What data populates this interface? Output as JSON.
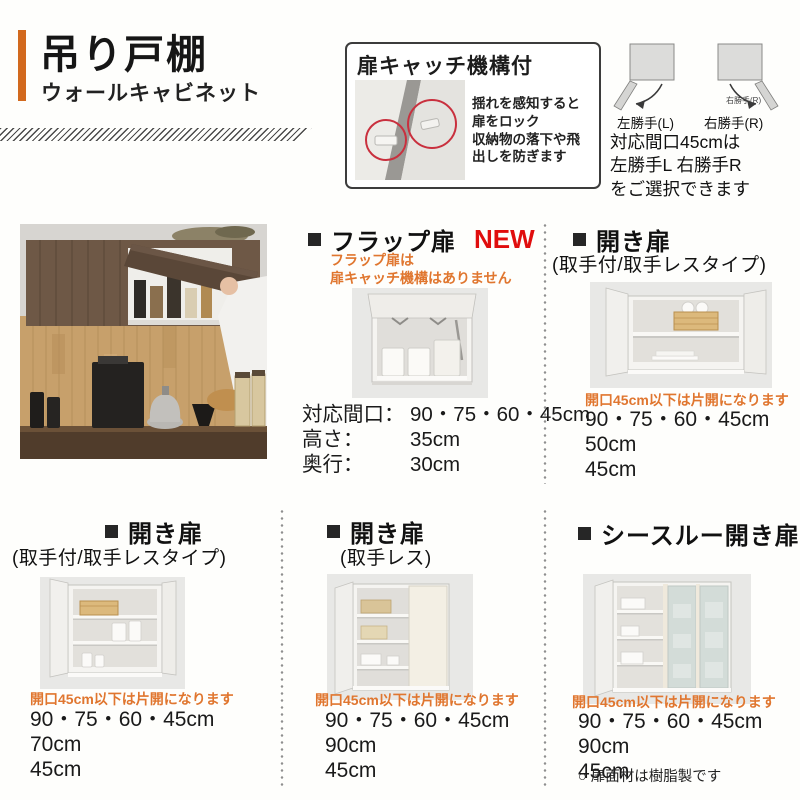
{
  "page": {
    "title": "吊り戸棚",
    "subtitle": "ウォールキャビネット"
  },
  "catch_box": {
    "title": "扉キャッチ機構付",
    "desc_line1": "揺れを感知すると",
    "desc_line2": "扉をロック",
    "desc_line3": "収納物の落下や飛",
    "desc_line4": "出しを防ぎます"
  },
  "handing": {
    "left_label": "左勝手(L)",
    "right_label": "右勝手(R)",
    "right_small_label": "右勝手(R)",
    "note_line1": "対応間口45cmは",
    "note_line2": "左勝手L 右勝手R",
    "note_line3": "をご選択できます"
  },
  "sections": {
    "flap": {
      "title": "フラップ扉",
      "badge": "NEW",
      "warning_line1": "フラップ扉は",
      "warning_line2": "扉キャッチ機構はありません",
      "spec_rows": [
        {
          "label": "対応間口：",
          "value": "90・75・60・45cm"
        },
        {
          "label": "高さ：",
          "value": "35cm"
        },
        {
          "label": "奥行：",
          "value": "30cm"
        }
      ]
    },
    "hinged_mid": {
      "title": "開き扉",
      "subtitle": "(取手付/取手レスタイプ)",
      "note": "開口45cm以下は片開になります",
      "widths": "90・75・60・45cm",
      "height": "50cm",
      "depth": "45cm"
    },
    "hinged_bottom_left": {
      "title": "開き扉",
      "subtitle": "(取手付/取手レスタイプ)",
      "note": "開口45cm以下は片開になります",
      "widths": "90・75・60・45cm",
      "height": "70cm",
      "depth": "45cm"
    },
    "handleless": {
      "title": "開き扉",
      "subtitle": "(取手レス)",
      "note": "開口45cm以下は片開になります",
      "widths": "90・75・60・45cm",
      "height": "90cm",
      "depth": "45cm"
    },
    "seethrough": {
      "title": "シースルー開き扉",
      "note": "開口45cm以下は片開になります",
      "widths": "90・75・60・45cm",
      "height": "90cm",
      "depth": "45cm",
      "footnote": "○ 扉面材は樹脂製です"
    }
  },
  "colors": {
    "accent_orange": "#d2691e",
    "note_orange": "#e0762f",
    "new_red": "#e00d0d",
    "text_black": "#1c1c1c"
  }
}
